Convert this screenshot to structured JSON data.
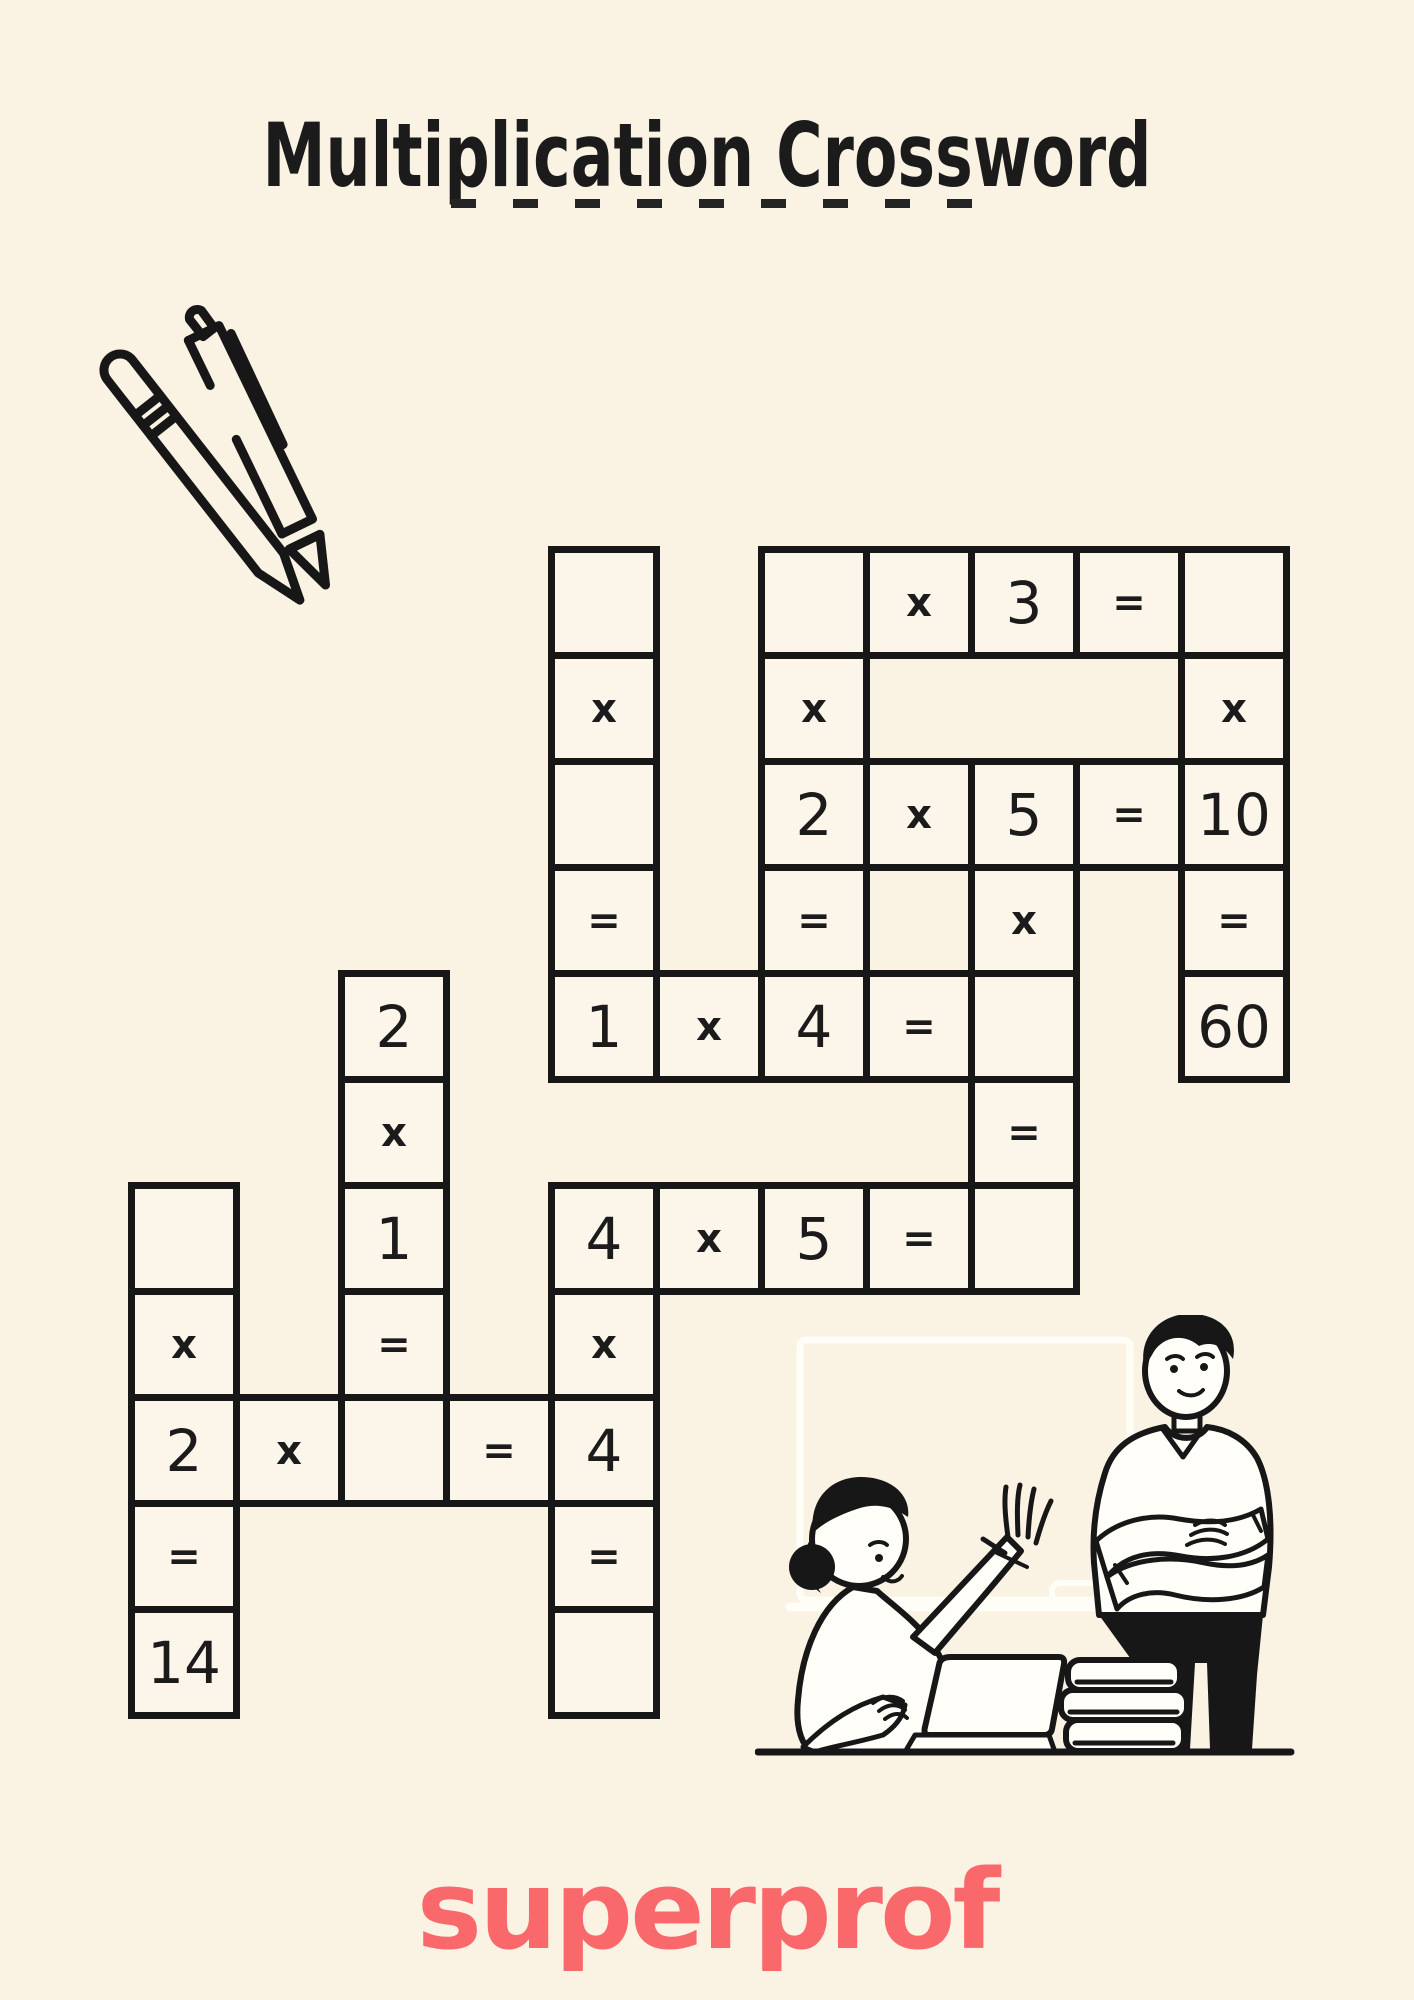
{
  "page": {
    "background_color": "#faf2e3",
    "ink_color": "#1b1b1b"
  },
  "header": {
    "title": "Multiplication Crossword"
  },
  "branding": {
    "logo_text": "superprof",
    "logo_color": "#f9696c"
  },
  "illustrations": {
    "pencils": "two-pens-line-drawing",
    "classroom": "student-raising-hand-at-laptop-with-teacher-arms-crossed-books-and-whiteboard"
  },
  "puzzle": {
    "operator_multiply": "x",
    "operator_equals": "=",
    "cells": [
      {
        "row": 0,
        "col": 4,
        "text": ""
      },
      {
        "row": 0,
        "col": 6,
        "text": ""
      },
      {
        "row": 0,
        "col": 7,
        "text": "x"
      },
      {
        "row": 0,
        "col": 8,
        "text": "3"
      },
      {
        "row": 0,
        "col": 9,
        "text": "="
      },
      {
        "row": 0,
        "col": 10,
        "text": ""
      },
      {
        "row": 1,
        "col": 4,
        "text": "x"
      },
      {
        "row": 1,
        "col": 6,
        "text": "x"
      },
      {
        "row": 1,
        "col": 10,
        "text": "x"
      },
      {
        "row": 2,
        "col": 4,
        "text": ""
      },
      {
        "row": 2,
        "col": 6,
        "text": "2"
      },
      {
        "row": 2,
        "col": 7,
        "text": "x"
      },
      {
        "row": 2,
        "col": 8,
        "text": "5"
      },
      {
        "row": 2,
        "col": 9,
        "text": "="
      },
      {
        "row": 2,
        "col": 10,
        "text": "10"
      },
      {
        "row": 3,
        "col": 4,
        "text": "="
      },
      {
        "row": 3,
        "col": 6,
        "text": "="
      },
      {
        "row": 3,
        "col": 8,
        "text": "x"
      },
      {
        "row": 3,
        "col": 10,
        "text": "="
      },
      {
        "row": 4,
        "col": 2,
        "text": "2"
      },
      {
        "row": 4,
        "col": 4,
        "text": "1"
      },
      {
        "row": 4,
        "col": 5,
        "text": "x"
      },
      {
        "row": 4,
        "col": 6,
        "text": "4"
      },
      {
        "row": 4,
        "col": 7,
        "text": "="
      },
      {
        "row": 4,
        "col": 8,
        "text": ""
      },
      {
        "row": 4,
        "col": 10,
        "text": "60"
      },
      {
        "row": 5,
        "col": 2,
        "text": "x"
      },
      {
        "row": 5,
        "col": 8,
        "text": "="
      },
      {
        "row": 6,
        "col": 0,
        "text": ""
      },
      {
        "row": 6,
        "col": 2,
        "text": "1"
      },
      {
        "row": 6,
        "col": 4,
        "text": "4"
      },
      {
        "row": 6,
        "col": 5,
        "text": "x"
      },
      {
        "row": 6,
        "col": 6,
        "text": "5"
      },
      {
        "row": 6,
        "col": 7,
        "text": "="
      },
      {
        "row": 6,
        "col": 8,
        "text": ""
      },
      {
        "row": 7,
        "col": 0,
        "text": "x"
      },
      {
        "row": 7,
        "col": 2,
        "text": "="
      },
      {
        "row": 7,
        "col": 4,
        "text": "x"
      },
      {
        "row": 8,
        "col": 0,
        "text": "2"
      },
      {
        "row": 8,
        "col": 1,
        "text": "x"
      },
      {
        "row": 8,
        "col": 2,
        "text": ""
      },
      {
        "row": 8,
        "col": 3,
        "text": "="
      },
      {
        "row": 8,
        "col": 4,
        "text": "4"
      },
      {
        "row": 9,
        "col": 0,
        "text": "="
      },
      {
        "row": 9,
        "col": 4,
        "text": "="
      },
      {
        "row": 10,
        "col": 0,
        "text": "14"
      },
      {
        "row": 10,
        "col": 4,
        "text": ""
      }
    ],
    "equations_across": [
      "_ x 3 = _",
      "2 x 5 = 10",
      "1 x 4 = _",
      "4 x 5 = _",
      "2 x _ = 4"
    ],
    "equations_down": [
      "_ x _ = 1",
      "_ x 2 = 4",
      "_ x 10 = 60",
      "5 x _ = _",
      "2 x 1 = _",
      "_ x 2 = 14",
      "4 x 4 = _"
    ]
  }
}
